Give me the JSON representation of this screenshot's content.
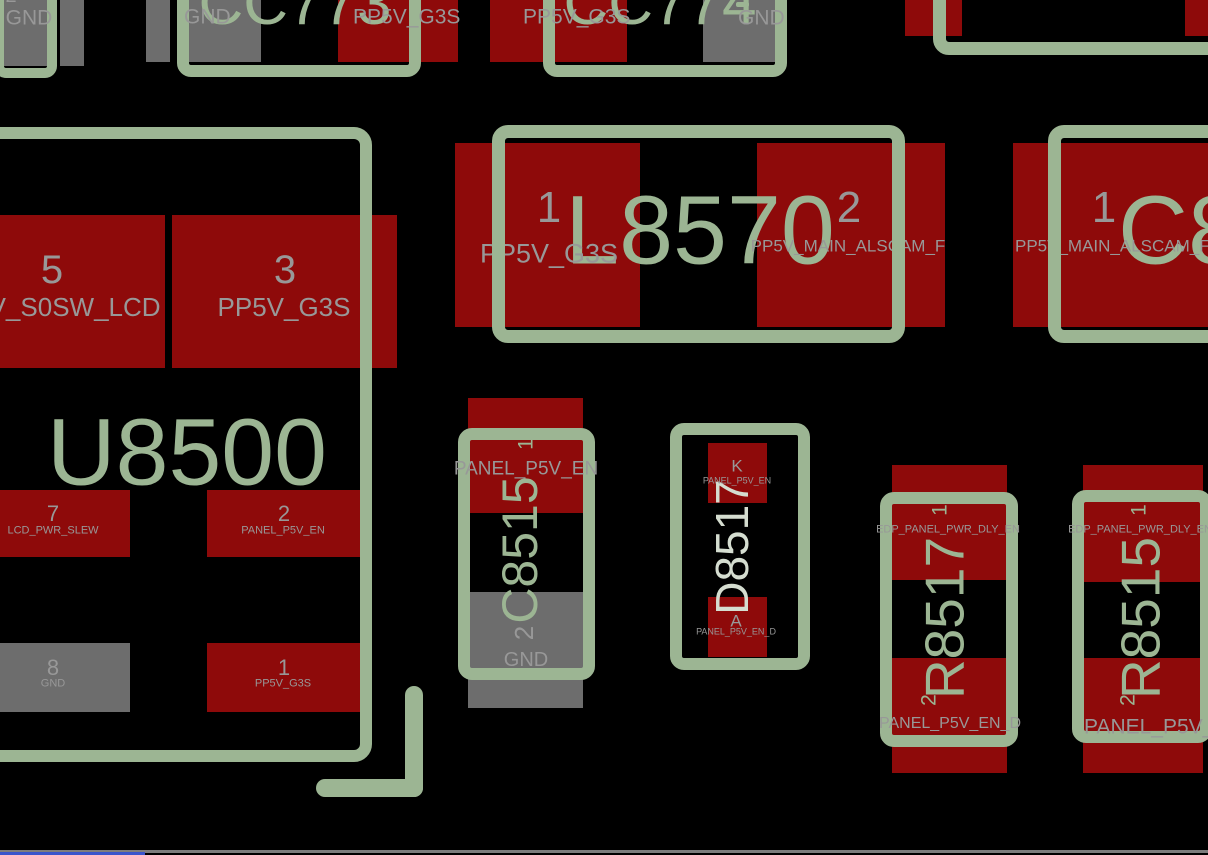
{
  "view": {
    "type": "pcb-layout-viewer"
  },
  "colors": {
    "background": "#000000",
    "pad_signal_red": "#8e0a0a",
    "pad_ground_gray": "#6d6d6d",
    "silkscreen_green": "#9cb593",
    "net_label_gray": "#989898",
    "refdes_pale": "#d5ddd0",
    "bottom_divider_gray": "#7d7d7d",
    "taskbar_blue": "#3a55cc"
  },
  "edge_component": {
    "pin2_num": "2",
    "pin2_net": "GND"
  },
  "cc773": {
    "refdes": "CC773",
    "gnd_net": "GND",
    "pwr_net": "PP5V_G3S"
  },
  "cc774": {
    "refdes": "CC774",
    "pwr_net": "PP5V_G3S",
    "gnd_net": "GND"
  },
  "l8570": {
    "refdes": "L8570",
    "pin1_num": "1",
    "pin1_net": "PP5V_G3S",
    "pin2_num": "2",
    "pin2_net": "PP5V_MAIN_ALSCAM_F"
  },
  "c8_partial": {
    "refdes": "C8",
    "pin1_num": "1",
    "pin1_net": "PP5V_MAIN_ALSCAM_F"
  },
  "u8500": {
    "refdes": "U8500",
    "pin5_num": "5",
    "pin5_net": "PP5V_S0SW_LCD",
    "pin3_num": "3",
    "pin3_net": "PP5V_G3S",
    "pin7_num": "7",
    "pin7_net": "LCD_PWR_SLEW",
    "pin2_num": "2",
    "pin2_net": "PANEL_P5V_EN",
    "pin8_num": "8",
    "pin8_net": "GND",
    "pin1_num": "1",
    "pin1_net": "PP5V_G3S"
  },
  "c8515": {
    "refdes": "C8515",
    "pin1_num": "1",
    "pin1_net": "PANEL_P5V_EN",
    "pin2_num": "2",
    "pin2_net": "GND"
  },
  "d8517": {
    "refdes": "D8517",
    "cathode_pin": "K",
    "cathode_net": "PANEL_P5V_EN",
    "anode_pin": "A",
    "anode_net": "PANEL_P5V_EN_D"
  },
  "r8517": {
    "refdes": "R8517",
    "pin1_num": "1",
    "pin1_net": "EDP_PANEL_PWR_DLY_EN",
    "pin2_num": "2",
    "pin2_net": "PANEL_P5V_EN_D"
  },
  "r8515": {
    "refdes": "R8515",
    "pin1_num": "1",
    "pin1_net": "EDP_PANEL_PWR_DLY_EN",
    "pin2_num": "2",
    "pin2_net": "PANEL_P5V_EN"
  }
}
